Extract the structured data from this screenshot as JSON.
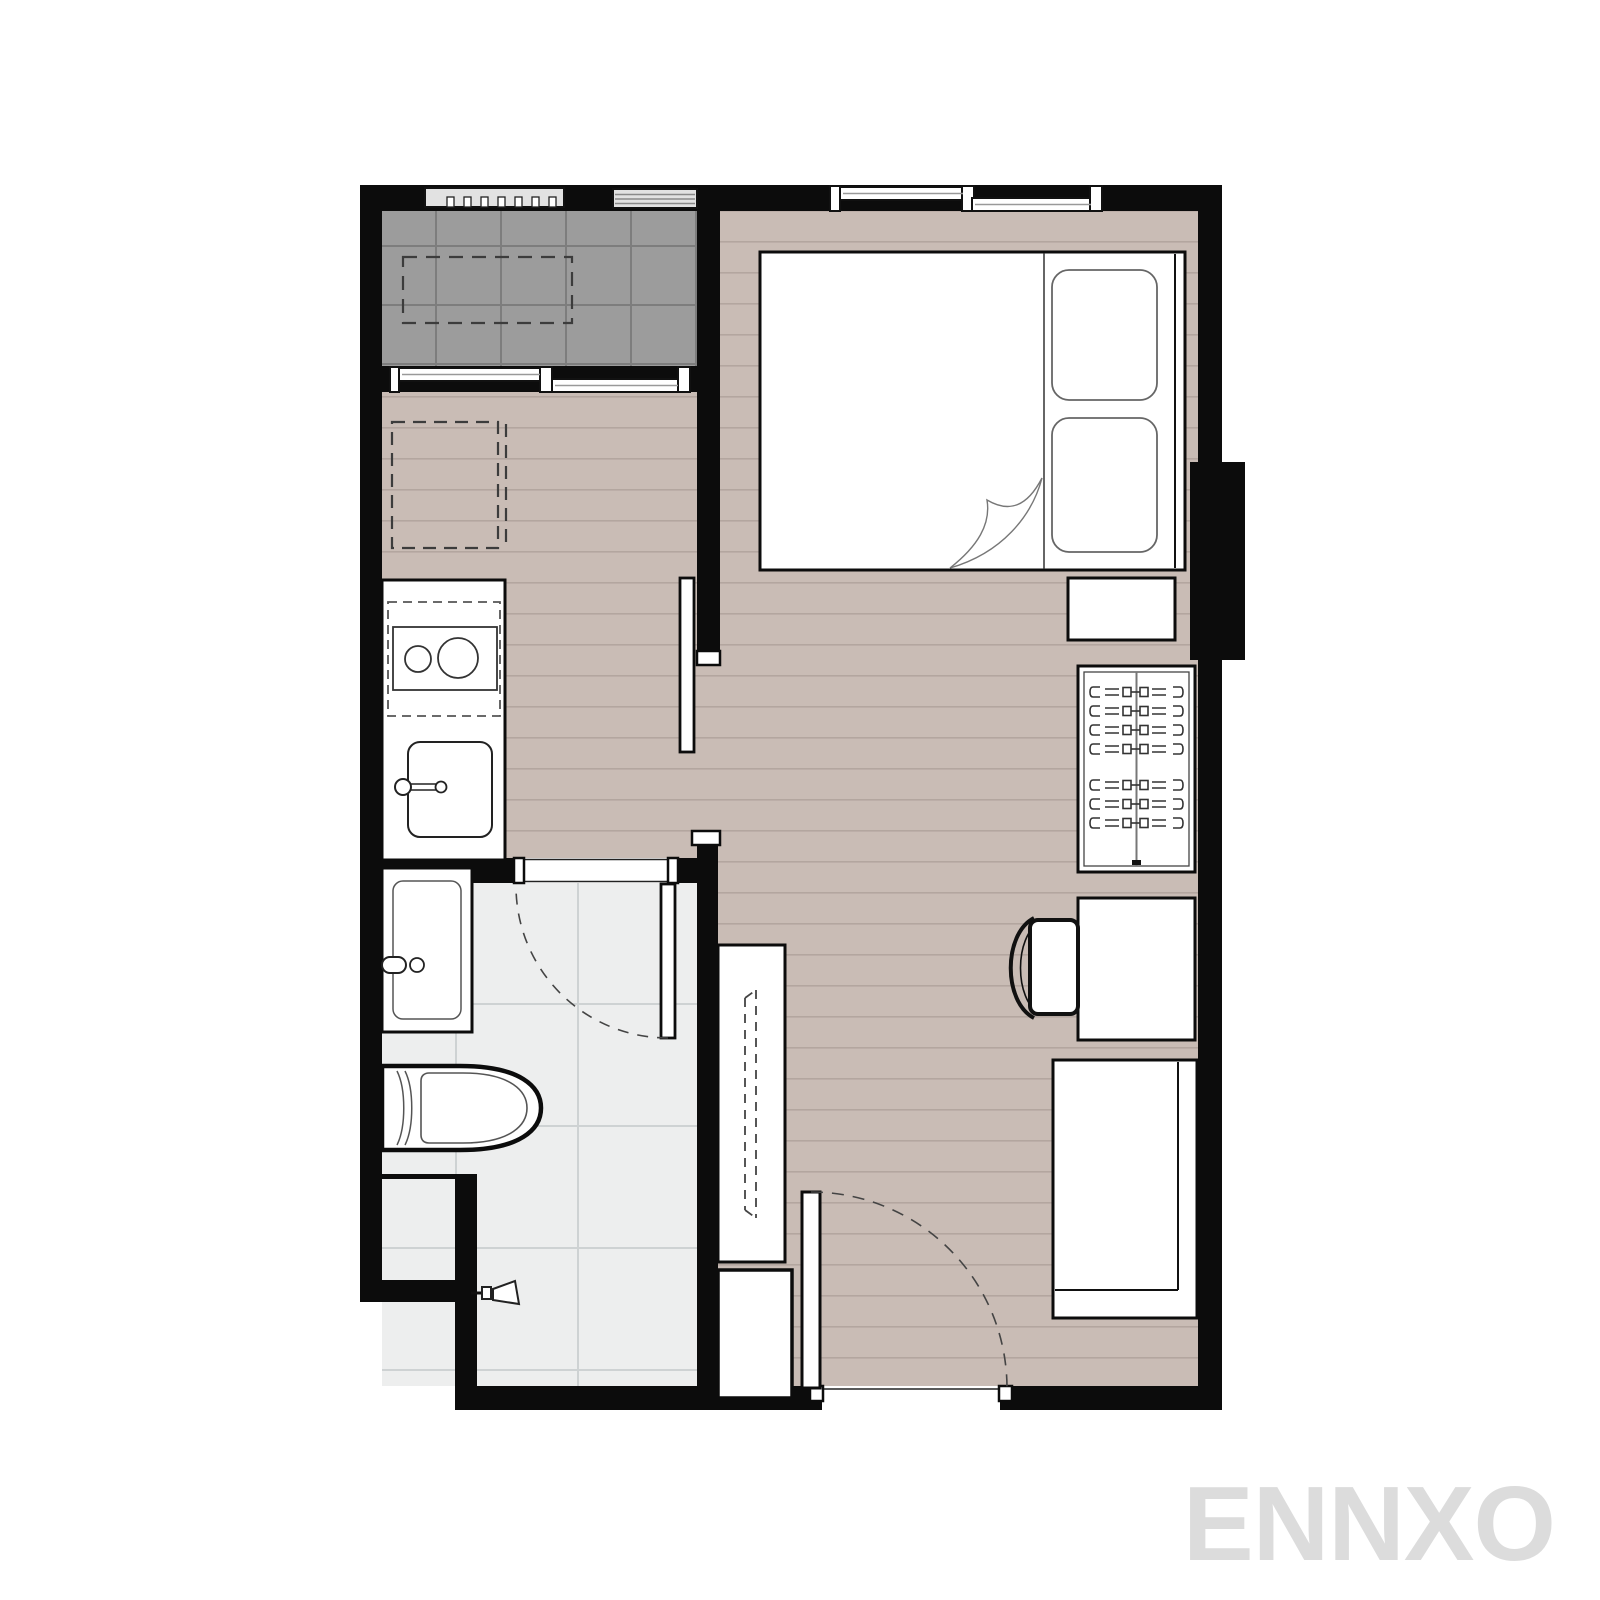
{
  "watermark": {
    "text": "ENNXO"
  },
  "palette": {
    "wall": "#0c0c0c",
    "floor": "#c9bcb5",
    "floor-line": "#b3a69f",
    "balcony": "#9c9c9c",
    "balcony-line": "#7d7d7d",
    "bath": "#edeeee",
    "bath-line": "#ced2d3",
    "louver": "#e2e2e2",
    "ink": "#1a1a1a",
    "thin": "#4a4a4a",
    "watermark": "#dcdcdc",
    "paper": "#ffffff"
  },
  "titles": {
    "plan": "Studio apartment floor plan",
    "balcony": "Balcony",
    "living": "Living / sleeping area",
    "bathroom": "Bathroom",
    "kitchen": "Kitchenette",
    "bed": "Double bed",
    "pillow": "Pillow",
    "blanket": "Blanket fold",
    "nightstand": "Nightstand",
    "wardrobe": "Wardrobe with hangers",
    "desk": "Desk",
    "chair": "Chair",
    "daybed": "Sofa bench",
    "tv_console": "TV console (wall-mounted TV dashed)",
    "shoe_cabinet": "Shoe cabinet",
    "counter": "Kitchen counter",
    "stove": "Two-burner hob with hood (dashed)",
    "kitchen_sink": "Kitchen sink",
    "fridge": "Refrigerator position (dashed)",
    "washer": "Washing machine position (dashed)",
    "bath_sink": "Washbasin",
    "toilet": "Toilet",
    "shower": "Shower",
    "entry_door": "Entrance door",
    "bath_door": "Bathroom door",
    "sliding_door": "Sliding partition door",
    "window_bedroom": "Bedroom sliding window",
    "window_balcony": "Balcony sliding door",
    "louver_a": "Louver vent",
    "louver_b": "Louver vent",
    "shaft": "Service shaft"
  }
}
